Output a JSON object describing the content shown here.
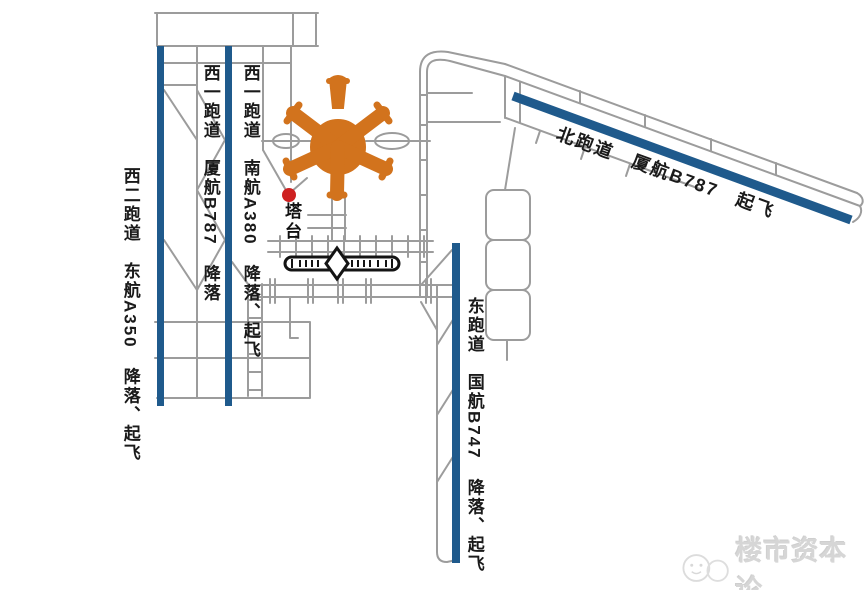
{
  "diagram": {
    "labels": {
      "west_runway_2": "西二跑道　东航A350　降落、起飞",
      "west_runway_1_xiamen": "西一跑道　厦航B787　降落",
      "west_runway_1_southern": "西一跑道　南航A380　降落、起飞",
      "north_runway": "北跑道　厦航B787　起飞",
      "east_runway": "东跑道　国航B747　降落、起飞",
      "tower": "塔台"
    },
    "colors": {
      "runway_blue": "#1F5A8C",
      "terminal_orange": "#D2731D",
      "taxiway_gray": "#9C9C9C",
      "marker_red": "#CE2121",
      "feature_black": "#141414"
    }
  },
  "watermark": {
    "text": "楼市资本论"
  }
}
